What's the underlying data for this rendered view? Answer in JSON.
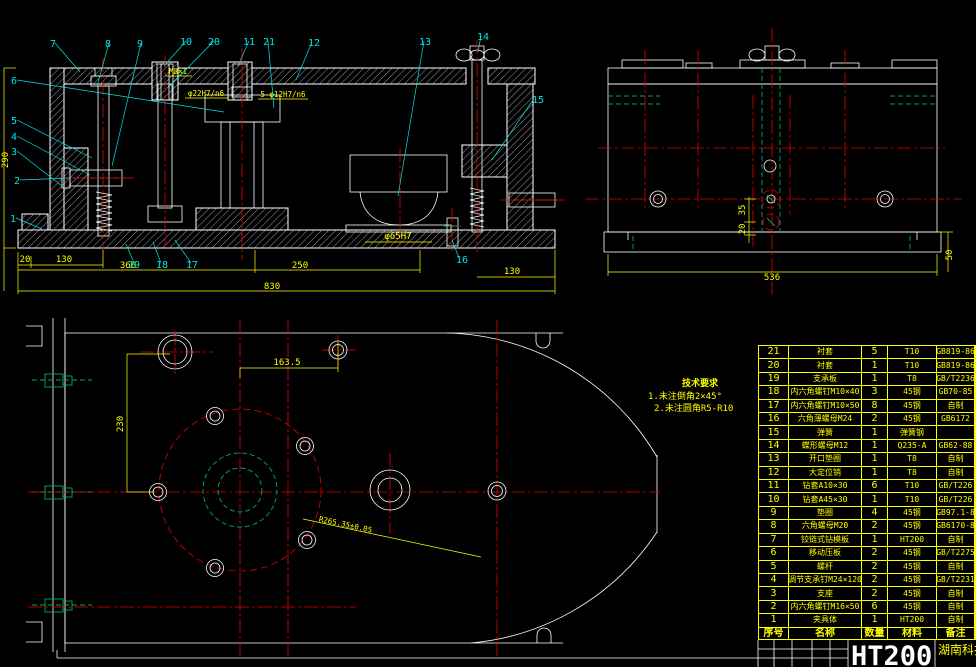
{
  "colors": {
    "background": "#000000",
    "line": "#ffffff",
    "dimension": "#ffff00",
    "centerline": "#e40000",
    "hidden_line": "#00a86b",
    "callout": "#00e5e5",
    "table_border": "#ffff00",
    "title_text": "#ffffff"
  },
  "callouts": [
    "1",
    "2",
    "3",
    "4",
    "5",
    "6",
    "7",
    "8",
    "9",
    "10",
    "11",
    "12",
    "13",
    "14",
    "15",
    "16",
    "17",
    "18",
    "19",
    "20",
    "21"
  ],
  "section_view": {
    "dim_20": "20",
    "dim_130_left": "130",
    "dim_366": "366",
    "dim_250": "250",
    "dim_130_right": "130",
    "dim_830": "830",
    "dim_height": "290",
    "bore_label": "φ65H7",
    "thread_label": "M8×1",
    "bushing_label_1": "φ22H7/n6",
    "bushing_label_2": "5-φ12H7/n6"
  },
  "side_view": {
    "dim_35": "35",
    "dim_20": "20",
    "dim_536": "536",
    "dim_50": "50"
  },
  "plan_view": {
    "dim_163_5": "163.5",
    "dim_230": "230",
    "radius_label": "R265.35±0.05"
  },
  "tech_requirements": {
    "title": "技术要求",
    "line1": "1.未注倒角2×45°",
    "line2": "2.未注圆角R5-R10"
  },
  "title_block": {
    "material": "HT200",
    "organization": "湖南科技大"
  },
  "bom": {
    "headers": [
      "序号",
      "名称",
      "数量",
      "材料",
      "备注"
    ],
    "rows": [
      {
        "no": "21",
        "name": "衬套",
        "qty": "5",
        "material": "T10",
        "note": "GB819-86"
      },
      {
        "no": "20",
        "name": "衬套",
        "qty": "1",
        "material": "T10",
        "note": "GB819-86"
      },
      {
        "no": "19",
        "name": "支承板",
        "qty": "1",
        "material": "T8",
        "note": "GB/T2236"
      },
      {
        "no": "18",
        "name": "内六角螺钉M10×40",
        "qty": "3",
        "material": "45钢",
        "note": "GB70-85"
      },
      {
        "no": "17",
        "name": "内六角螺钉M10×50",
        "qty": "8",
        "material": "45钢",
        "note": "自制"
      },
      {
        "no": "16",
        "name": "六角薄螺母M24",
        "qty": "2",
        "material": "45钢",
        "note": "GB6172"
      },
      {
        "no": "15",
        "name": "弹簧",
        "qty": "1",
        "material": "弹簧钢",
        "note": ""
      },
      {
        "no": "14",
        "name": "蝶形螺母M12",
        "qty": "1",
        "material": "Q235-A",
        "note": "GB62-88"
      },
      {
        "no": "13",
        "name": "开口垫圈",
        "qty": "1",
        "material": "T8",
        "note": "自制"
      },
      {
        "no": "12",
        "name": "大定位销",
        "qty": "1",
        "material": "T8",
        "note": "自制"
      },
      {
        "no": "11",
        "name": "钻套A10×30",
        "qty": "6",
        "material": "T10",
        "note": "GB/T226"
      },
      {
        "no": "10",
        "name": "钻套A45×30",
        "qty": "1",
        "material": "T10",
        "note": "GB/T226"
      },
      {
        "no": "9",
        "name": "垫圈",
        "qty": "4",
        "material": "45钢",
        "note": "GB97.1-8"
      },
      {
        "no": "8",
        "name": "六角螺母M20",
        "qty": "2",
        "material": "45钢",
        "note": "GB6170-8"
      },
      {
        "no": "7",
        "name": "铰链式钻模板",
        "qty": "1",
        "material": "HT200",
        "note": "自制"
      },
      {
        "no": "6",
        "name": "移动压板",
        "qty": "2",
        "material": "45钢",
        "note": "GB/T2275"
      },
      {
        "no": "5",
        "name": "螺杆",
        "qty": "2",
        "material": "45钢",
        "note": "自制"
      },
      {
        "no": "4",
        "name": "调节支承钉M24×120",
        "qty": "2",
        "material": "45钢",
        "note": "GB/T2231"
      },
      {
        "no": "3",
        "name": "支座",
        "qty": "2",
        "material": "45钢",
        "note": "自制"
      },
      {
        "no": "2",
        "name": "内六角螺钉M16×50",
        "qty": "6",
        "material": "45钢",
        "note": "自制"
      },
      {
        "no": "1",
        "name": "夹具体",
        "qty": "1",
        "material": "HT200",
        "note": "自制"
      }
    ]
  }
}
